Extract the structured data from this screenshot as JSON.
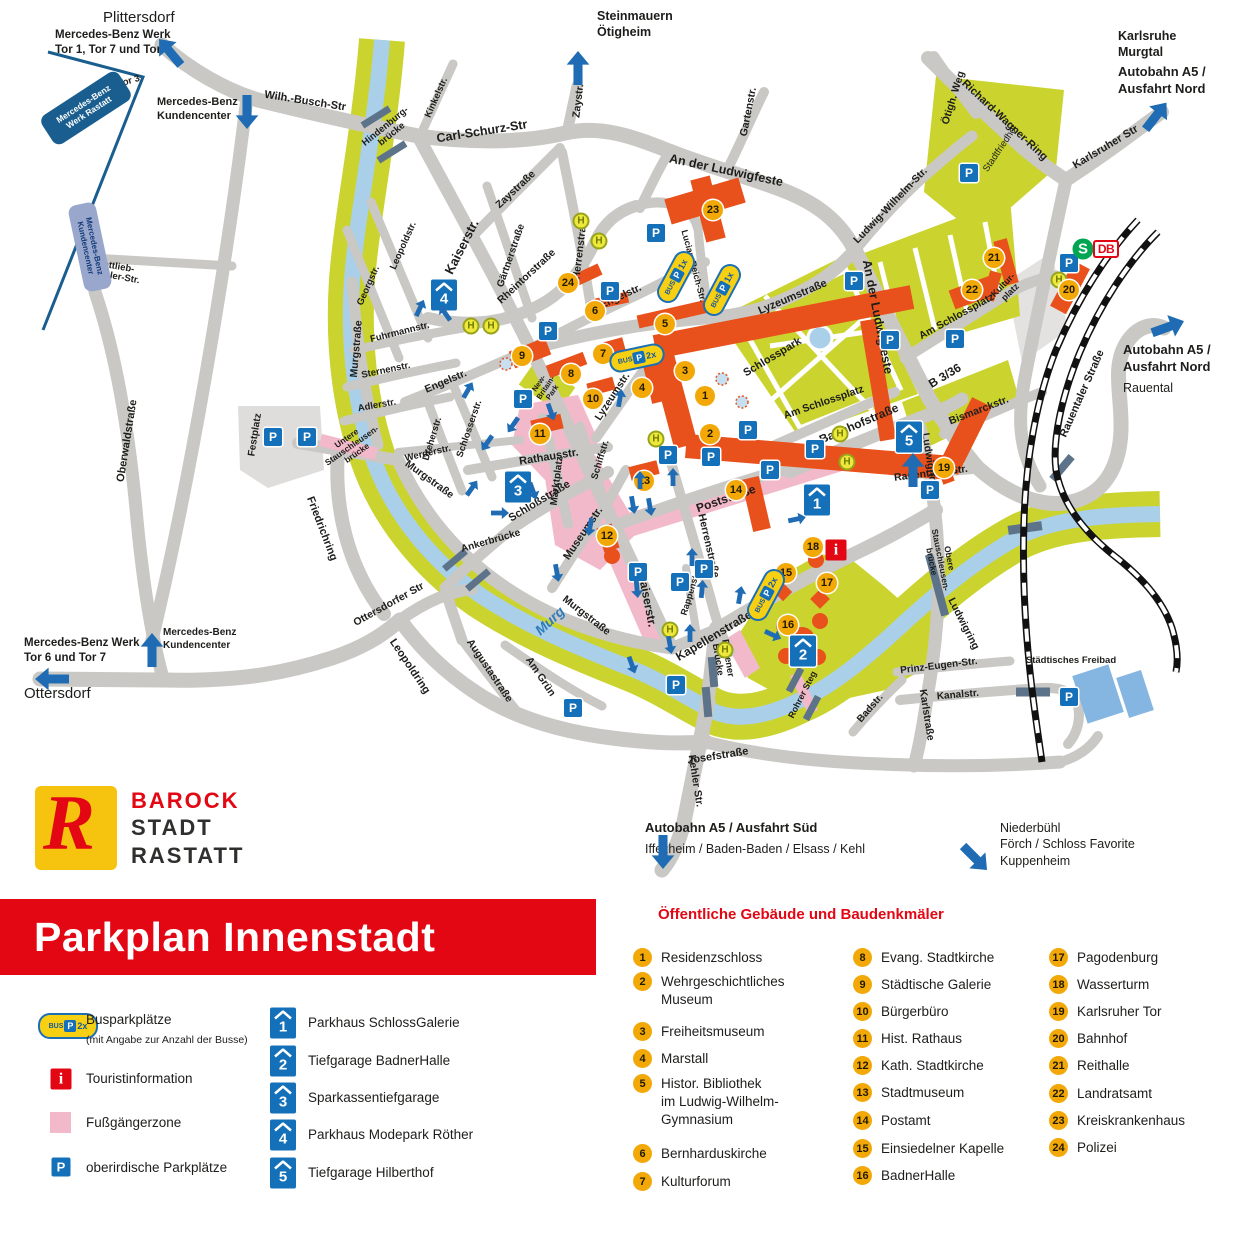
{
  "title": "Parkplan Innenstadt",
  "logo": {
    "line1": "BAROCK",
    "line2": "STADT",
    "line3": "RASTATT",
    "mark": "R"
  },
  "legend": {
    "bus_label": "Busparkplätze",
    "bus_sub": "(mit Angabe zur Anzahl der Busse)",
    "bus_count_sample": "2x",
    "info_label": "Touristinformation",
    "zone_label": "Fußgängerzone",
    "parking_label": "oberirdische Parkplätze"
  },
  "garages": [
    {
      "num": "1",
      "name": "Parkhaus SchlossGalerie"
    },
    {
      "num": "2",
      "name": "Tiefgarage BadnerHalle"
    },
    {
      "num": "3",
      "name": "Sparkassentiefgarage"
    },
    {
      "num": "4",
      "name": "Parkhaus Modepark Röther"
    },
    {
      "num": "5",
      "name": "Tiefgarage Hilberthof"
    }
  ],
  "buildings_header": "Öffentliche Gebäude und Baudenkmäler",
  "buildings": [
    {
      "num": "1",
      "name": "Residenzschloss"
    },
    {
      "num": "2",
      "name": "Wehrgeschichtliches\nMuseum"
    },
    {
      "num": "3",
      "name": "Freiheitsmuseum"
    },
    {
      "num": "4",
      "name": "Marstall"
    },
    {
      "num": "5",
      "name": "Histor. Bibliothek\nim Ludwig-Wilhelm-\nGymnasium"
    },
    {
      "num": "6",
      "name": "Bernharduskirche"
    },
    {
      "num": "7",
      "name": "Kulturforum"
    },
    {
      "num": "8",
      "name": "Evang. Stadtkirche"
    },
    {
      "num": "9",
      "name": "Städtische Galerie"
    },
    {
      "num": "10",
      "name": "Bürgerbüro"
    },
    {
      "num": "11",
      "name": "Hist. Rathaus"
    },
    {
      "num": "12",
      "name": "Kath. Stadtkirche"
    },
    {
      "num": "13",
      "name": "Stadtmuseum"
    },
    {
      "num": "14",
      "name": "Postamt"
    },
    {
      "num": "15",
      "name": "Einsiedelner Kapelle"
    },
    {
      "num": "16",
      "name": "BadnerHalle"
    },
    {
      "num": "17",
      "name": "Pagodenburg"
    },
    {
      "num": "18",
      "name": "Wasserturm"
    },
    {
      "num": "19",
      "name": "Karlsruher Tor"
    },
    {
      "num": "20",
      "name": "Bahnhof"
    },
    {
      "num": "21",
      "name": "Reithalle"
    },
    {
      "num": "22",
      "name": "Landratsamt"
    },
    {
      "num": "23",
      "name": "Kreiskrankenhaus"
    },
    {
      "num": "24",
      "name": "Polizei"
    }
  ],
  "map": {
    "icons": {
      "parking": "P",
      "bus_stop": "H",
      "info": "i",
      "sbahn": "S",
      "db": "DB",
      "bus": "BUS"
    },
    "bus_ovals": [
      "2x",
      "1x",
      "1x",
      "2x"
    ],
    "mercedes_boxes": [
      {
        "lines": "Mercedes-Benz\nWerk Rastatt"
      },
      {
        "lines": "Mercedes-Benz\nKundencenter"
      }
    ],
    "labels": [
      "Wilh.-Busch-Str",
      "Carl-Schurz-Str",
      "Kinkelstr.",
      "Zaystr.",
      "Zaystraße",
      "Gartenstr.",
      "An der Ludwigfeste",
      "An der Ludwigfeste",
      "Richard-Wagner-Ring",
      "Ötigh. Weg",
      "Karlsruher Str",
      "Ludwig-Wilhelm-Str.",
      "Kaiserstr.",
      "Leopoldstr.",
      "Georgstr.",
      "Gärtnerstraße",
      "Herrenstraße",
      "Rheintorstraße",
      "Fuhrmannstr.",
      "Sternenstr.",
      "Adlerstr.",
      "Murgstraße",
      "Murgstraße",
      "Murgstraße",
      "Engelstr.",
      "Engelstr.",
      "Lucian-Reich-Str.",
      "Lyzeumstraße",
      "Lyzeumstr.",
      "Schlosserstr.",
      "Dreherstr.",
      "Werderstr.",
      "Rathausstr.",
      "Marktplatz",
      "Schloßstraße",
      "Schiffstr.",
      "Museumstr.",
      "Poststraße",
      "Herrenstraße",
      "Rappenstr.",
      "Kaiserstr.",
      "Kapellenstraße",
      "Bahnhofstraße",
      "B 3/36",
      "Bismarckstr.",
      "Rauentaler Straße",
      "Rauentaler Str.",
      "Ludwigring",
      "Ludwigring",
      "Festplatz",
      "Friedrichring",
      "Oberwaldstraße",
      "Ottersdorfer Str",
      "Leopoldring",
      "Augustastraße",
      "Am Grün",
      "Kehler Str.",
      "Josefstraße",
      "Karlstraße",
      "Prinz-Eugen-Str.",
      "Kanalstr.",
      "Badstr.",
      "Am Schlossplatz",
      "Am Schlossplatz",
      "Tor 3",
      "Gottlieb-\nDaimler-Str.",
      "Hindenburg-\nbrücke",
      "Untere\nStauschleusen-\nbrücke",
      "Obere\nStauschleusen-\nbrücke",
      "Badener\nBrücke",
      "Ankerbrücke",
      "Rohrer Steg",
      "Murg",
      "Schlosspark",
      "Stadtfriedhof",
      "New-\nBritain-\nPark",
      "Städtisches Freibad",
      "Kultur-\nplatz"
    ],
    "destinations": [
      {
        "lines": "Plittersdorf"
      },
      {
        "lines": "Mercedes-Benz Werk\nTor 1, Tor 7 und Tor 6"
      },
      {
        "lines": "Mercedes-Benz\nKundencenter"
      },
      {
        "lines": "Steinmauern\nÖtigheim"
      },
      {
        "lines": "Karlsruhe\nMurgtal"
      },
      {
        "lines": "Autobahn A5 /\nAusfahrt Nord"
      },
      {
        "lines": "Autobahn A5 /\nAusfahrt Nord"
      },
      {
        "lines": "Rauental"
      },
      {
        "lines": "Mercedes-Benz Werk\nTor 6 und Tor 7"
      },
      {
        "lines": "Ottersdorf"
      },
      {
        "lines": "Mercedes-Benz\nKundencenter"
      },
      {
        "lines": "Autobahn A5 / Ausfahrt Süd"
      },
      {
        "lines": "Iffezheim / Baden-Baden / Elsass / Kehl"
      },
      {
        "lines": "Niederbühl\nFörch / Schloss Favorite\nKuppenheim"
      }
    ]
  },
  "colors": {
    "accent_red": "#e30613",
    "road": "#c9c8c4",
    "park": "#cbd42e",
    "water": "#a9cfe9",
    "landmark": "#e8511c",
    "badge": "#f2a907",
    "parking_blue": "#1470b8",
    "ped_zone": "#f2b9ca"
  }
}
